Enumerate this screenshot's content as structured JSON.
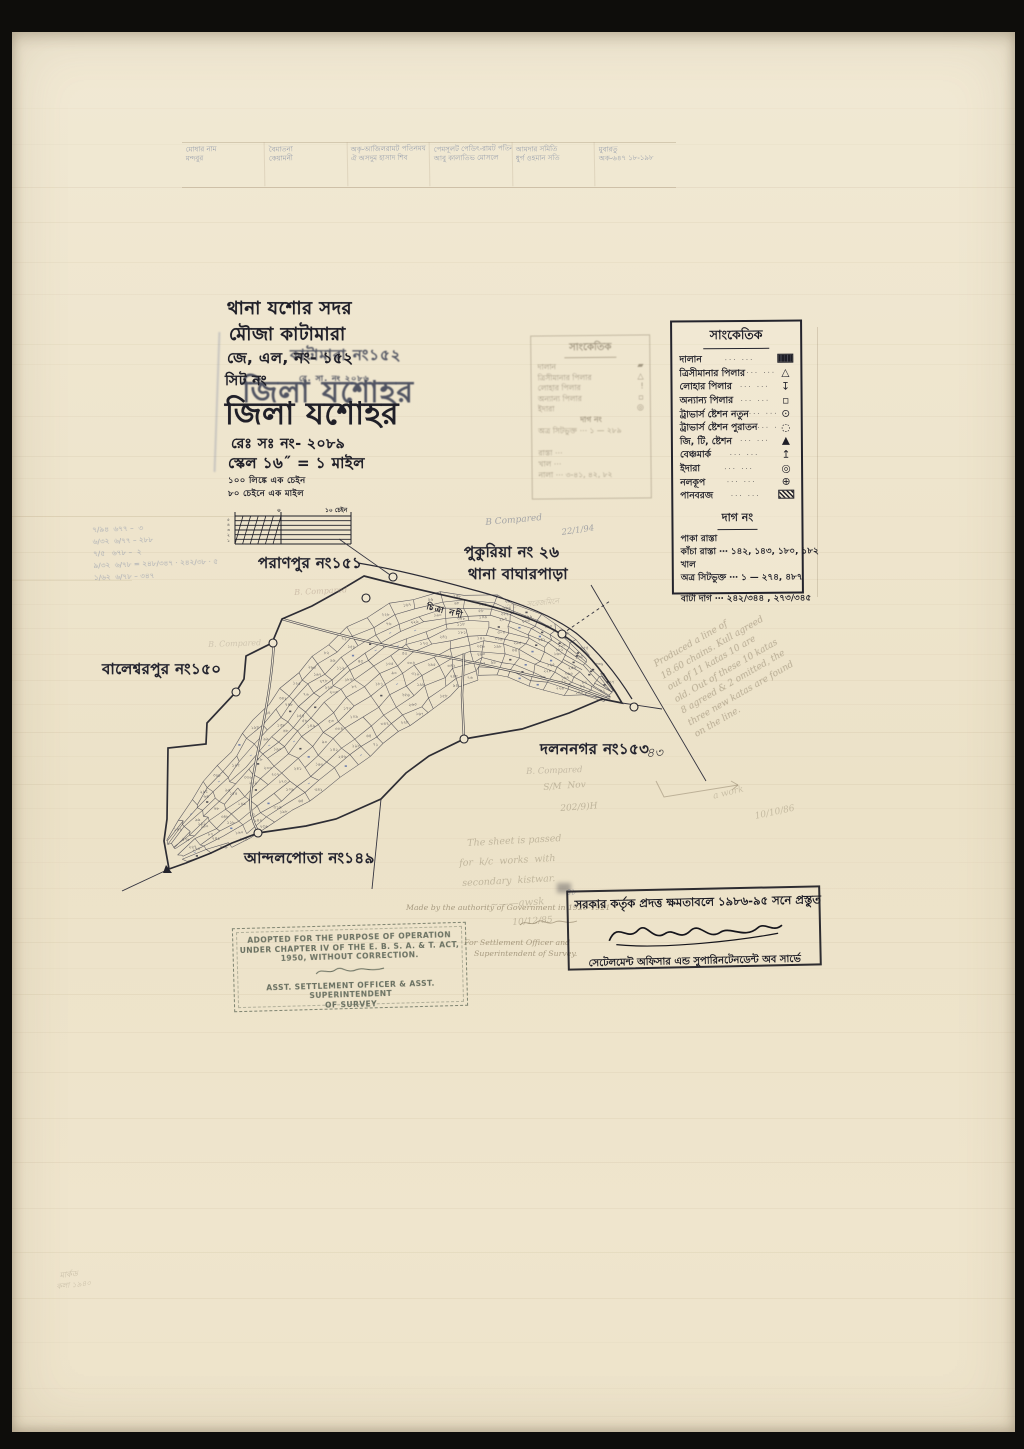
{
  "colors": {
    "ink": "#1f1f28",
    "paper": "#efe6cf",
    "pencil": "#8b8068",
    "ghost_blue": "#64749b"
  },
  "header_notes": {
    "cells": [
      [
        "মোষার নাম",
        "মন্দবুর"
      ],
      [
        "বৈমাতনা",
        "কেয়ামনী"
      ],
      [
        "অকৃ-আজিলরামট পতিনময",
        "ঐ অসদুম হাসাদ শিব"
      ],
      [
        "পেমসূলট পেডিৎ-রামট পতিনমর",
        "আবু কালাতিভ মোসলে"
      ],
      [
        "আমদার সমিতি",
        "ধুর্গ ওহমান সতি"
      ],
      [
        "মুবারতু",
        "অক-৬৪৭ ১৮-১৯৮"
      ]
    ]
  },
  "title_block": {
    "thana": "থানা যশোর সদর",
    "mouza": "মৌজা কাটামারা",
    "jl_no": "জে, এল, নং- ১৫২",
    "sheet": "সিট নং",
    "district": "জিলা যশোহর",
    "reg_no": "রেঃ সঃ নং- ২০৮৯",
    "scale": "স্কেল ১৬˝ = ১ মাইল",
    "ghost_district": "জিলা যশোহর",
    "ghost_mouza": "কাটামারা নং১৫২",
    "ghost_reg": "রে. সা. নং ২০৮৬"
  },
  "scale_bar": {
    "note1": "১০০ লিঙ্কে এক চেইন",
    "note2": "৮০ চেইনে এক মাইল",
    "zero_label": "০",
    "right_label": "১০ চেইন",
    "left_ticks": [
      "৫",
      "৪",
      "৩",
      "২",
      "১"
    ]
  },
  "legend": {
    "title": "সাংকেতিক",
    "items": [
      {
        "label": "দালান",
        "sym": "building"
      },
      {
        "label": "ত্রিসীমানার পিলার",
        "sym": "triangle"
      },
      {
        "label": "লোহার পিলার",
        "sym": "iron-pillar"
      },
      {
        "label": "অন্যান্য পিলার",
        "sym": "square"
      },
      {
        "label": "ট্রাভার্স ষ্টেশন নতুন",
        "sym": "circle-dot"
      },
      {
        "label": "ট্রাভার্স ষ্টেশন পুরাতন",
        "sym": "circle-dashed"
      },
      {
        "label": "জি, টি, ষ্টেশন",
        "sym": "triangle-filled"
      },
      {
        "label": "বেঞ্চমার্ক",
        "sym": "benchmark"
      },
      {
        "label": "ইদারা",
        "sym": "bullseye"
      },
      {
        "label": "নলকূপ",
        "sym": "circle-plus"
      },
      {
        "label": "পানবরজ",
        "sym": "hatched-rect"
      }
    ],
    "dag_title": "দাগ নং",
    "dag_rows": [
      "পাকা রাস্তা",
      "কাঁচা রাস্তা ⋯ ১৪২, ১৪৩, ১৮০, ১৮২",
      "খাল",
      "অত্র সিটভুক্ত ⋯ ১ — ২৭৪, ৪৮৭"
    ],
    "bata_row": "বাটা দাগ ⋯ ২৪২/৩৪৪ , ২৭৩/৩৪৫"
  },
  "ghost_legend": {
    "title": "সাংকেতিক",
    "rows": [
      {
        "label": "দালান",
        "sym": "▰"
      },
      {
        "label": "ত্রিসীমানার পিলার",
        "sym": "△"
      },
      {
        "label": "লোহার পিলার",
        "sym": "!"
      },
      {
        "label": "অন্যান্য পিলার",
        "sym": "▫"
      },
      {
        "label": "ইদারা",
        "sym": "◎"
      }
    ],
    "extra": [
      "দাগ নং",
      "অত্র সিটভুক্ত ⋯ ১ — ২৮৯",
      "",
      "রাস্তা ⋯",
      "খাল ⋯",
      "নালা ⋯ ৩-৪১, ৪২, ৮২"
    ]
  },
  "map": {
    "river_label": "চিত্রা নদী",
    "neighbors": [
      {
        "text": "পরাণপুর নং১৫১",
        "x": 246,
        "y": 520,
        "s": 15
      },
      {
        "text": "পুকুরিয়া নং ২৬",
        "x": 452,
        "y": 509,
        "s": 15
      },
      {
        "text": "থানা বাঘারপাড়া",
        "x": 456,
        "y": 531,
        "s": 15
      },
      {
        "text": "বালেশ্বরপুর নং১৫০",
        "x": 90,
        "y": 626,
        "s": 15
      },
      {
        "text": "দলননগর নং১৫৩",
        "x": 528,
        "y": 706,
        "s": 15
      },
      {
        "text": "আন্দলপোতা নং১৪৯",
        "x": 232,
        "y": 815,
        "s": 15
      }
    ],
    "plot_numbers": [
      "১৪২",
      "২০৭",
      "৬৮",
      "১২৫",
      "৩০৪",
      "১৮৬",
      "৯৪",
      "২৫৬",
      "১৭৩",
      "৪৫",
      "২২৮",
      "৩১৯",
      "৮৭",
      "১৫৪",
      "২৬৩",
      "১০৯",
      "৩৪৮",
      "৭৬",
      "১৯৮",
      "২৪১",
      "৫৮",
      "১৬৭",
      "২৯৫",
      "১১৮",
      "৩৩৬",
      "৮২",
      "২১৪",
      "১৪৯",
      "২৭৮",
      "৬৪",
      "১৮১",
      "২৫২",
      "৯৯",
      "৩০৮",
      "১৩৫",
      "২২৯",
      "৭১",
      "১৬০",
      "২৮৭",
      "১১২",
      "৩৪২",
      "৯০",
      "২০৩",
      "১৫৮",
      "২৭০",
      "৫৩",
      "১৯০",
      "২৪৮"
    ],
    "boundary": "M55,318 L50,290 L53,268 L54,197 L92,193 L93,172 L122,141 L130,128 L132,105 L158,92 L168,68 L198,55 L225,40 L250,25 C292,36 330,44 364,52 C406,62 440,76 460,92 C478,106 494,128 508,152 L488,148 L455,162 L408,178 L350,188 L315,205 L292,222 L267,248 L222,268 L192,275 L144,282 L118,292 L97,302 L72,312 Z",
    "river_outer": "M244,12 C280,18 320,28 356,38 C402,50 438,64 462,82 C482,98 502,122 518,148",
    "roads": [
      "M168,68 C210,80 255,92 300,100 C345,108 400,120 448,132 L496,149",
      "M160,90 C158,130 150,170 142,210 C136,243 132,264 146,283",
      "M350,102 L348,144 L350,188"
    ],
    "survey_lines": [
      {
        "d": "M225,-12 L279,26",
        "dash": false
      },
      {
        "d": "M477,34 L592,230",
        "dash": false
      },
      {
        "d": "M448,83 L496,50",
        "dash": true
      },
      {
        "d": "M508,152 L548,158",
        "dash": false
      },
      {
        "d": "M267,248 L258,338",
        "dash": false
      },
      {
        "d": "M55,318 L8,340",
        "dash": false
      }
    ],
    "circles": [
      [
        279,
        26
      ],
      [
        252,
        47
      ],
      [
        159,
        92
      ],
      [
        122,
        141
      ],
      [
        448,
        83
      ],
      [
        520,
        156
      ],
      [
        350,
        188
      ],
      [
        144,
        282
      ]
    ],
    "spine": [
      [
        60,
        298
      ],
      [
        92,
        270
      ],
      [
        122,
        244
      ],
      [
        150,
        216
      ],
      [
        176,
        190
      ],
      [
        202,
        164
      ],
      [
        230,
        140
      ],
      [
        260,
        117
      ],
      [
        292,
        97
      ],
      [
        328,
        82
      ],
      [
        366,
        76
      ],
      [
        402,
        84
      ],
      [
        436,
        101
      ],
      [
        468,
        121
      ],
      [
        496,
        143
      ]
    ],
    "halfwidth": [
      18,
      36,
      46,
      54,
      60,
      64,
      66,
      68,
      66,
      58,
      48,
      43,
      38,
      26,
      9
    ]
  },
  "margin_calcs": [
    "৭/৯৪  ৬৭৭ –  ৩",
    "৬/৩২  ৬/৭৭ – ২৮৮",
    "৭/৫   ৬৭৮ –  ২",
    "৯/৩২  ৬/৭৮ = ২৪৮/৩৪৭ · ২৪২/৩৮ · ৫",
    "১/৬২  ৬/৭৮ – ৩৪৭"
  ],
  "survey_note_lines": [
    "Produced  a  line  of",
    "18.60 chains.  Kull agreed",
    "out of 11 katas 10 are",
    "old. Out of these 10 katas",
    "8 agreed & 2 omitted, the",
    "three new katas are found",
    "on the line."
  ],
  "pencil_notes": [
    {
      "text": "B Compared",
      "x": 473,
      "y": 486,
      "r": -5,
      "s": 9,
      "o": 0.5,
      "c": "#5a6480"
    },
    {
      "text": "22/1/94",
      "x": 549,
      "y": 496,
      "r": -8,
      "s": 8.5,
      "o": 0.5,
      "c": "#5a6480"
    },
    {
      "text": "B. Compared",
      "x": 282,
      "y": 556,
      "r": -3,
      "s": 8,
      "o": 0.38,
      "c": "#9c8373"
    },
    {
      "text": "B. Compared",
      "x": 196,
      "y": 608,
      "r": -2,
      "s": 8,
      "o": 0.3,
      "c": "#8d8272"
    },
    {
      "text": "৩/৪— সরেজমিনে",
      "x": 492,
      "y": 570,
      "r": -6,
      "s": 7.5,
      "o": 0.33,
      "c": "#7c7362"
    },
    {
      "text": "B. Compared",
      "x": 514,
      "y": 735,
      "r": -2,
      "s": 8.5,
      "o": 0.42,
      "c": "#8d8272"
    },
    {
      "text": "S/M  Nov",
      "x": 531,
      "y": 751,
      "r": -4,
      "s": 9,
      "o": 0.4,
      "c": "#80765f"
    },
    {
      "text": "202/9)H",
      "x": 548,
      "y": 772,
      "r": -4,
      "s": 9,
      "o": 0.42,
      "c": "#80765f"
    },
    {
      "text": "The sheet is passed",
      "x": 455,
      "y": 806,
      "r": -3,
      "s": 9.5,
      "o": 0.45,
      "c": "#8b8068"
    },
    {
      "text": "for  k/c  works  with",
      "x": 447,
      "y": 826,
      "r": -3,
      "s": 9.5,
      "o": 0.45,
      "c": "#8b8068"
    },
    {
      "text": "secondary  kistwar.",
      "x": 450,
      "y": 846,
      "r": -3,
      "s": 9.5,
      "o": 0.45,
      "c": "#8b8068"
    },
    {
      "text": "~——awsk",
      "x": 478,
      "y": 868,
      "r": -4,
      "s": 10,
      "o": 0.4,
      "c": "#8b8068"
    },
    {
      "text": "10/12/85",
      "x": 500,
      "y": 886,
      "r": -4,
      "s": 9,
      "o": 0.42,
      "c": "#8b8068"
    },
    {
      "text": "a work",
      "x": 700,
      "y": 760,
      "r": -14,
      "s": 9,
      "o": 0.35,
      "c": "#8b8068"
    },
    {
      "text": "10/10/86",
      "x": 742,
      "y": 780,
      "r": -12,
      "s": 9,
      "o": 0.4,
      "c": "#8b8068"
    },
    {
      "text": "৪৩",
      "x": 634,
      "y": 712,
      "r": 0,
      "s": 13,
      "o": 0.85,
      "c": "#1f1f28"
    },
    {
      "text": "৪৮",
      "x": 553,
      "y": 853,
      "r": 0,
      "s": 9,
      "o": 0.5,
      "c": "#55607f"
    },
    {
      "text": "মার্কড",
      "x": 47,
      "y": 1238,
      "r": -6,
      "s": 8,
      "o": 0.35,
      "c": "#837863"
    },
    {
      "text": "কলা ১৯৪০",
      "x": 44,
      "y": 1250,
      "r": -6,
      "s": 7.5,
      "o": 0.32,
      "c": "#837863"
    }
  ],
  "stamps": {
    "bengali_stamp": {
      "line1": "সরকার কর্তৃক প্রদত্ত ক্ষমতাবলে ১৯৮৬-৯৫ সনে প্রস্তুত",
      "line2": "সেটেলমেন্ট অফিসার এন্ড সুপারিনটেনডেন্ট অব সার্ভে"
    },
    "english_stamp": {
      "lines": [
        "ADOPTED FOR THE PURPOSE OF OPERATION",
        "UNDER CHAPTER IV OF THE E. B. S. A. & T. ACT,",
        "1950, WITHOUT CORRECTION.",
        "ASST. SETTLEMENT OFFICER & ASST. SUPERINTENDENT",
        "OF SURVEY"
      ]
    },
    "print_note": {
      "line1": "Made by the authority of Government in 1920-1921",
      "line2": "For Settlement Officer and",
      "line3": "Superintendent of Survey."
    }
  }
}
